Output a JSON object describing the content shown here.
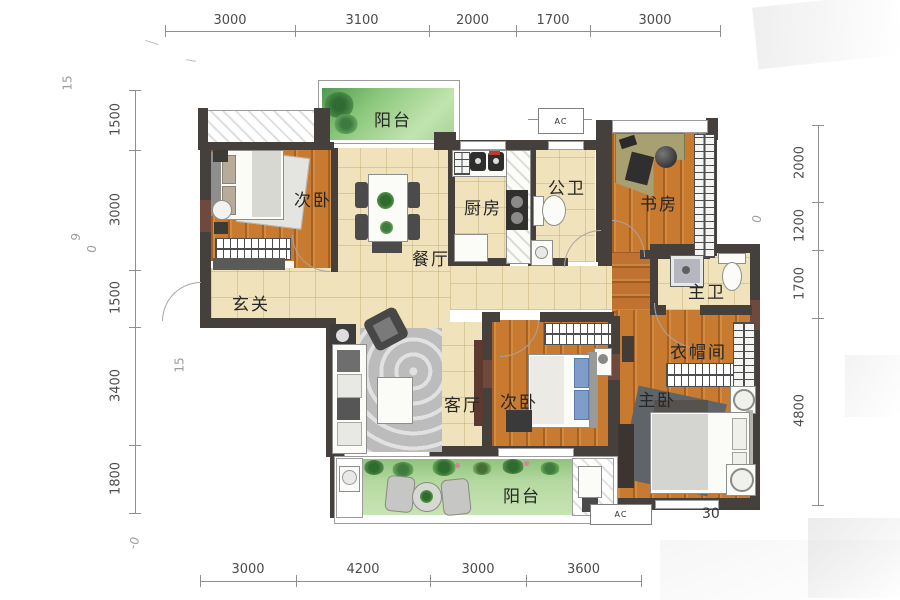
{
  "plan": {
    "type": "apartment-floor-plan",
    "rooms": {
      "balcony_top": "阳台",
      "bedroom_a": "次卧",
      "dining": "餐厅",
      "kitchen": "厨房",
      "bath_public": "公卫",
      "study": "书房",
      "entry": "玄关",
      "bath_master": "主卫",
      "living": "客厅",
      "bedroom_b": "次卧",
      "master": "主卧",
      "cloakroom": "衣帽间",
      "balcony_bottom": "阳台"
    },
    "ac_label": "AC",
    "dims": {
      "top": [
        "3000",
        "3100",
        "2000",
        "1700",
        "3000"
      ],
      "bottom": [
        "3000",
        "4200",
        "3000",
        "3600"
      ],
      "left": [
        "1500",
        "3000",
        "1500",
        "3400",
        "1800"
      ],
      "right": [
        "2000",
        "1200",
        "1700",
        "4800"
      ]
    },
    "stray": {
      "top_left": "15",
      "mid_left_a": "9",
      "mid_left_b": "0",
      "entry_left": "15",
      "study_right": "0",
      "bottom_left": "-0",
      "bottom_right": "30"
    },
    "colors": {
      "wall": "#45403b",
      "wall_accent": "#6e4a3e",
      "tile_floor": "#f0e2ba",
      "wood_floor": "#c87a31",
      "balcony_green": "#aed69a",
      "dim_text": "#4c4c4c"
    }
  }
}
